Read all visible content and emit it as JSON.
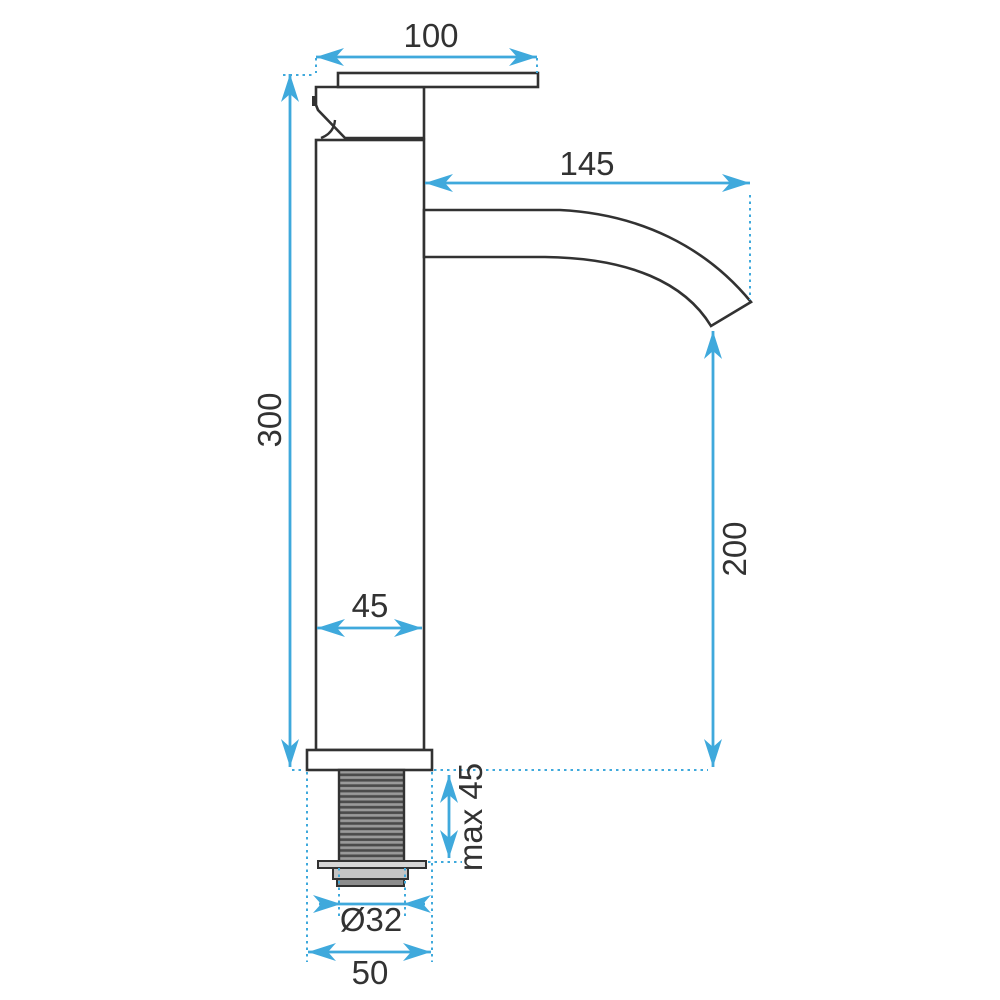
{
  "colors": {
    "dimension_blue": "#3fa9dc",
    "line_dark": "#323232",
    "thread_gray": "#9a9a9a",
    "thread_stripe": "#4b4b4b",
    "metal_light": "#d6d6d6",
    "metal_mid": "#c4c4c4",
    "metal_dark": "#8d8d8d",
    "background": "#ffffff"
  },
  "drawing": {
    "type": "technical-dimension-drawing",
    "subject": "tall single-lever basin faucet, side view",
    "dimensions": {
      "handle_plate_width": "100",
      "spout_reach": "145",
      "body_height": "300",
      "body_width": "45",
      "spout_outlet_height": "200",
      "mounting_depth": "max 45",
      "thread_diameter": "Ø32",
      "base_width": "50"
    }
  }
}
